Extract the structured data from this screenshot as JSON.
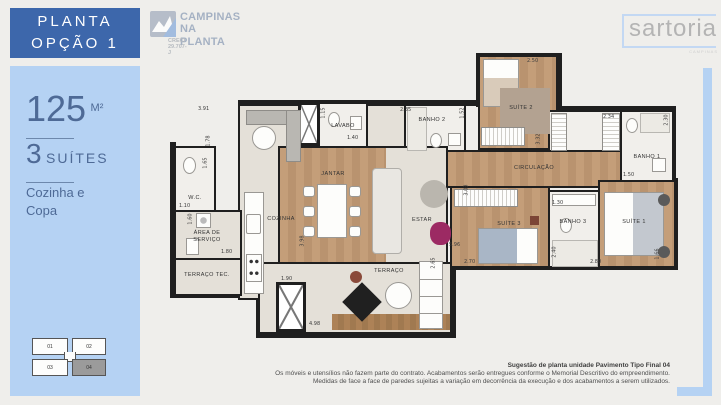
{
  "header": {
    "line1": "PLANTA",
    "line2": "OPÇÃO 1"
  },
  "sidebar": {
    "area_value": "125",
    "area_unit": "M²",
    "suites_value": "3",
    "suites_label": "SUÍTES",
    "feature_line1": "Cozinha e",
    "feature_line2": "Copa",
    "keyplan": {
      "units": [
        "01",
        "02",
        "03",
        "04"
      ],
      "highlighted_unit": "04"
    }
  },
  "logos": {
    "campinas": {
      "line1": "CAMPINAS",
      "line2": "NA PLANTA",
      "creci": "CRECI 29.707-J"
    },
    "sartoria": {
      "name": "sartoria",
      "sub": "CAMPINAS"
    }
  },
  "floorplan": {
    "room_labels": {
      "lavabo": "LAVABO",
      "banho2": "BANHO 2",
      "suite2": "SUÍTE 2",
      "circulacao": "CIRCULAÇÃO",
      "banho1": "BANHO 1",
      "wc": "W.C.",
      "cozinha": "COZINHA",
      "area_servico": "ÁREA DE SERVIÇO",
      "terraco_tec": "TERRAÇO TEC.",
      "jantar": "JANTAR",
      "estar": "ESTAR",
      "suite3": "SUÍTE 3",
      "banho3": "BANHO 3",
      "suite1": "SUÍTE 1",
      "terraco": "TERRAÇO"
    },
    "measurements": [
      "3.91",
      "1.78",
      "1.65",
      "1.10",
      "1.60",
      "1.80",
      "1.90",
      "1.15",
      "1.40",
      "2.35",
      "1.52",
      "2.50",
      "2.34",
      "2.30",
      "1.50",
      "3.03",
      "1.30",
      "2.40",
      "2.70",
      "2.80",
      "1.66",
      "3.98",
      "4.98",
      "2.65",
      "5.96",
      "3.32"
    ]
  },
  "footer": {
    "title": "Sugestão de planta unidade Pavimento Tipo Final 04",
    "line1": "Os móveis e utensílios não fazem parte do contrato. Acabamentos serão entregues conforme o Memorial Descritivo do empreendimento.",
    "line2": "Medidas de face a face de paredes sujeitas a variação em decorrência da execução e dos acabamentos a serem utilizados."
  },
  "colors": {
    "header_blue": "#3d67ab",
    "panel_blue": "#b5d2f3",
    "text_blue": "#4e6a96",
    "wall": "#1f1f1f",
    "wood": "#c49e79",
    "magenta_chair": "#9c2a63"
  }
}
